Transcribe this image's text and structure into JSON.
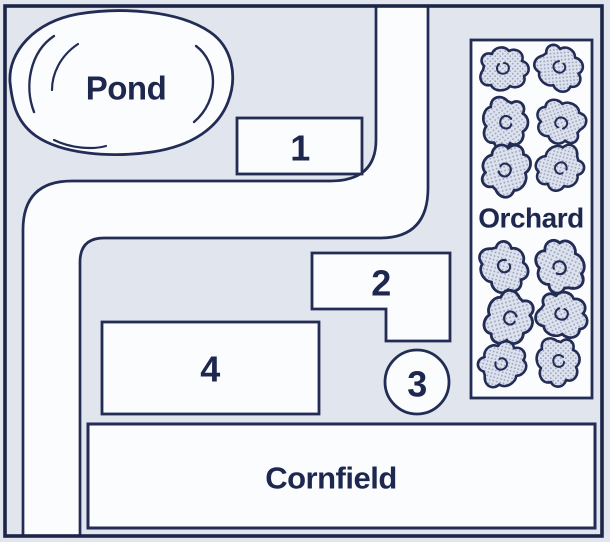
{
  "map": {
    "pond": {
      "label": "Pond"
    },
    "orchard": {
      "label": "Orchard",
      "tree_count": 12
    },
    "cornfield": {
      "label": "Cornfield"
    },
    "buildings": [
      {
        "id": "building-1",
        "label": "1",
        "shape": "rectangle"
      },
      {
        "id": "building-2",
        "label": "2",
        "shape": "l-shape"
      },
      {
        "id": "building-3",
        "label": "3",
        "shape": "circle"
      },
      {
        "id": "building-4",
        "label": "4",
        "shape": "rectangle"
      }
    ]
  },
  "colors": {
    "line": "#232c55",
    "text": "#1e274d",
    "background": "#e1e5ee",
    "surface": "#fbfcfe",
    "tree_fill": "#dde2ec",
    "tree_dot": "#9ba6c6"
  }
}
